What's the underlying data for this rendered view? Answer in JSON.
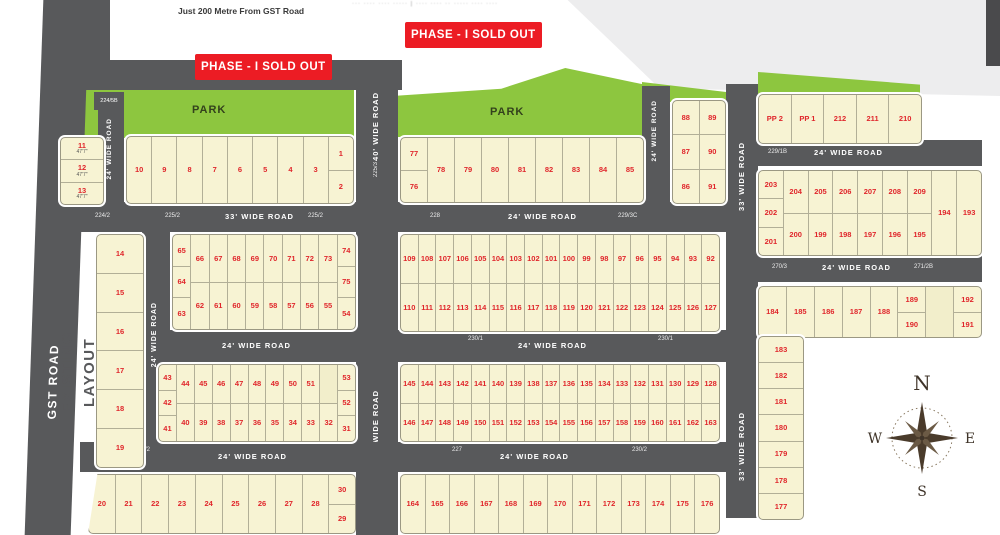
{
  "page": {
    "top_note": "Just 200 Metre From GST Road",
    "fine_print": "··· ···· ···· ····· | ···· ···· ·· ····· ···· ····",
    "phase_banner_1": "PHASE - I SOLD OUT",
    "phase_banner_2": "PHASE - I SOLD OUT"
  },
  "labels": {
    "gst_road": "GST ROAD",
    "existing_layout": "EXISTING LAYOUT",
    "existing_layout_line1": "EXISTING",
    "existing_layout_line2": "LAYOUT",
    "park_left": "PARK",
    "park_center": "PARK"
  },
  "compass": {
    "north": "N",
    "east": "E",
    "south": "S",
    "west": "W"
  },
  "colors": {
    "road": "#58595b",
    "plot_fill": "#f7f3d3",
    "plot_number": "#e0262b",
    "park": "#8dc63f",
    "banner_red": "#ec1c24"
  },
  "roads": {
    "gst": {
      "label": "GST ROAD"
    },
    "r40": {
      "label_top": "40' WIDE ROAD",
      "survey_top": "225/3",
      "survey_mid": "226",
      "label_bottom": "40' WIDE ROAD"
    },
    "r24_top_left": {
      "cap": "224/5B",
      "label": "24' WIDE ROAD"
    },
    "r24_left": {
      "label": "24' WIDE ROAD"
    },
    "r33_h": {
      "survey_1": "224/2",
      "survey_2": "225/2",
      "label_west": "33' WIDE ROAD",
      "survey_3": "225/2",
      "survey_4": "228",
      "label_east": "24' WIDE ROAD",
      "survey_5": "229/3C"
    },
    "r24_mid": {
      "label_west": "24' WIDE ROAD",
      "survey_1": "230/1",
      "label_east": "24' WIDE ROAD",
      "survey_2": "230/1"
    },
    "r24_low": {
      "survey_1": "225/2",
      "label_west": "24' WIDE ROAD",
      "survey_2": "227",
      "label_east": "24' WIDE ROAD",
      "survey_3": "230/2"
    },
    "r24_center": {
      "label": "24' WIDE ROAD"
    },
    "r33_v": {
      "label_top": "33' WIDE ROAD",
      "label_bottom": "33' WIDE ROAD"
    },
    "r24_right_1": {
      "survey": "229/1B",
      "label": "24' WIDE ROAD"
    },
    "r24_right_2": {
      "survey_1": "270/3",
      "label": "24' WIDE ROAD",
      "survey_2": "271/2B"
    }
  },
  "blocks": {
    "b11": {
      "cols": [
        [
          "11",
          "12",
          "13"
        ]
      ],
      "dims": [
        "47'7\"",
        "47'7\"",
        "47'7\""
      ]
    },
    "b14": {
      "cols": [
        [
          "14",
          "15",
          "16",
          "17",
          "18",
          "19"
        ]
      ]
    },
    "b1": {
      "cols": [
        [
          "10"
        ],
        [
          "9"
        ],
        [
          "8"
        ],
        [
          "7"
        ],
        [
          "6"
        ],
        [
          "5"
        ],
        [
          "4"
        ],
        [
          "3"
        ],
        [
          "1",
          "2"
        ]
      ]
    },
    "m1": {
      "cols": [
        [
          "65",
          "64",
          "63"
        ],
        [
          "66",
          "62"
        ],
        [
          "67",
          "61"
        ],
        [
          "68",
          "60"
        ],
        [
          "69",
          "59"
        ],
        [
          "70",
          "58"
        ],
        [
          "71",
          "57"
        ],
        [
          "72",
          "56"
        ],
        [
          "73",
          "55"
        ],
        [
          "74",
          "75",
          "54"
        ]
      ]
    },
    "m2": {
      "cols": [
        [
          "43",
          "42",
          "41"
        ],
        [
          "44",
          "40"
        ],
        [
          "45",
          "39"
        ],
        [
          "46",
          "38"
        ],
        [
          "47",
          "37"
        ],
        [
          "48",
          "36"
        ],
        [
          "49",
          "35"
        ],
        [
          "50",
          "34"
        ],
        [
          "51",
          "33"
        ],
        [
          "",
          "32"
        ],
        [
          "53",
          "52",
          "31"
        ]
      ]
    },
    "m3": {
      "cols": [
        [
          "20"
        ],
        [
          "21"
        ],
        [
          "22"
        ],
        [
          "23"
        ],
        [
          "24"
        ],
        [
          "25"
        ],
        [
          "26"
        ],
        [
          "27"
        ],
        [
          "28"
        ],
        [
          "30",
          "29"
        ]
      ]
    },
    "b2": {
      "cols": [
        [
          "77",
          "76"
        ],
        [
          "78"
        ],
        [
          "79"
        ],
        [
          "80"
        ],
        [
          "81"
        ],
        [
          "82"
        ],
        [
          "83"
        ],
        [
          "84"
        ],
        [
          "85"
        ]
      ]
    },
    "b3": {
      "cols": [
        [
          "88",
          "87",
          "86"
        ],
        [
          "89",
          "90",
          "91"
        ]
      ]
    },
    "b4": {
      "cols": [
        [
          "PP 2"
        ],
        [
          "PP 1"
        ],
        [
          "212"
        ],
        [
          "211"
        ],
        [
          "210"
        ]
      ]
    },
    "b5": {
      "cols": [
        [
          "203",
          "202",
          "201"
        ],
        [
          "204",
          "200"
        ],
        [
          "205",
          "199"
        ],
        [
          "206",
          "198"
        ],
        [
          "207",
          "197"
        ],
        [
          "208",
          "196"
        ],
        [
          "209",
          "195"
        ],
        [
          "194"
        ],
        [
          "193"
        ]
      ]
    },
    "b6": {
      "cols": [
        [
          "184"
        ],
        [
          "185"
        ],
        [
          "186"
        ],
        [
          "187"
        ],
        [
          "188"
        ],
        [
          "189",
          "190"
        ],
        [
          ""
        ],
        [
          "192",
          "191"
        ]
      ]
    },
    "b7": {
      "cols": [
        [
          "183",
          "182",
          "181",
          "180",
          "179",
          "178",
          "177"
        ]
      ]
    },
    "c1": {
      "cols": [
        [
          "109",
          "110"
        ],
        [
          "108",
          "111"
        ],
        [
          "107",
          "112"
        ],
        [
          "106",
          "113"
        ],
        [
          "105",
          "114"
        ],
        [
          "104",
          "115"
        ],
        [
          "103",
          "116"
        ],
        [
          "102",
          "117"
        ],
        [
          "101",
          "118"
        ],
        [
          "100",
          "119"
        ],
        [
          "99",
          "120"
        ],
        [
          "98",
          "121"
        ],
        [
          "97",
          "122"
        ],
        [
          "96",
          "123"
        ],
        [
          "95",
          "124"
        ],
        [
          "94",
          "125"
        ],
        [
          "93",
          "126"
        ],
        [
          "92",
          "127"
        ]
      ]
    },
    "c2": {
      "cols": [
        [
          "145",
          "146"
        ],
        [
          "144",
          "147"
        ],
        [
          "143",
          "148"
        ],
        [
          "142",
          "149"
        ],
        [
          "141",
          "150"
        ],
        [
          "140",
          "151"
        ],
        [
          "139",
          "152"
        ],
        [
          "138",
          "153"
        ],
        [
          "137",
          "154"
        ],
        [
          "136",
          "155"
        ],
        [
          "135",
          "156"
        ],
        [
          "134",
          "157"
        ],
        [
          "133",
          "158"
        ],
        [
          "132",
          "159"
        ],
        [
          "131",
          "160"
        ],
        [
          "130",
          "161"
        ],
        [
          "129",
          "162"
        ],
        [
          "128",
          "163"
        ]
      ]
    },
    "c3": {
      "cols": [
        [
          "164"
        ],
        [
          "165"
        ],
        [
          "166"
        ],
        [
          "167"
        ],
        [
          "168"
        ],
        [
          "169"
        ],
        [
          "170"
        ],
        [
          "171"
        ],
        [
          "172"
        ],
        [
          "173"
        ],
        [
          "174"
        ],
        [
          "175"
        ],
        [
          "176"
        ]
      ]
    }
  }
}
